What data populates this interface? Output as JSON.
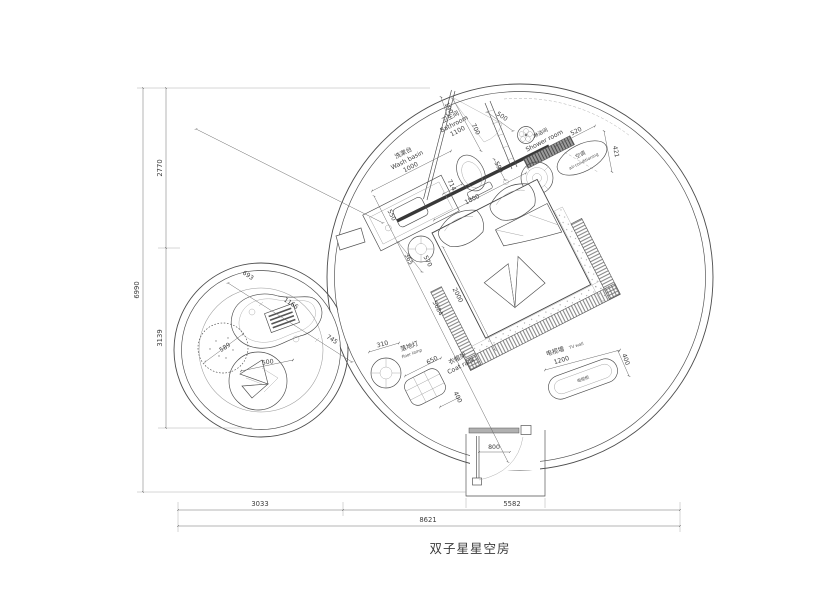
{
  "title": "双子星星空房",
  "colors": {
    "line": "#4c4c4c",
    "dim_line": "#6a6a6a",
    "text": "#3d3d3d",
    "wall_thick": "#383838",
    "bench_fill": "#9a9a9a",
    "door_bar_fill": "#b0b0b0"
  },
  "labels": {
    "washbasin": {
      "cn": "洗漱台",
      "en": "Wash basin",
      "dim": "1000"
    },
    "bathroom": {
      "cn": "卫生间",
      "en": "Bathroom",
      "dim": "1100"
    },
    "shower": {
      "cn": "淋浴间",
      "en": "Shower room"
    },
    "ac": {
      "cn": "空调",
      "en": "air-conditioning"
    },
    "floor_lamp": {
      "cn": "落地灯",
      "en": "floor lamp"
    },
    "coat_rack": {
      "cn": "衣帽架",
      "en": "Coat rack"
    },
    "tv_wall": {
      "cn": "电视墙",
      "en": "TV wall"
    },
    "tv_cabinet": {
      "cn": "电视柜"
    }
  },
  "dims": {
    "overall_height": "6990",
    "upper_height": "2770",
    "lower_height": "3139",
    "bottom_left": "3033",
    "bottom_right": "5582",
    "overall_width": "8621",
    "top_gap": "190",
    "bath_span": "700",
    "shower_door": "500",
    "bench_len": "520",
    "ac_gap": "421",
    "wall_door": "590",
    "toilet_gap": "714",
    "head_wall": "1800",
    "basin_depth": "550",
    "table_d": "365",
    "table_gap": "570",
    "bed_w": "2000",
    "room_diag": "5684",
    "lamp_d": "310",
    "coat_w": "650",
    "coat_d": "400",
    "tv_w": "1200",
    "tv_d": "400",
    "entry_door": "800",
    "lounge_a": "693",
    "lounge_b": "1166",
    "lounge_c": "745",
    "pouf_d": "589",
    "chair_d": "500"
  }
}
